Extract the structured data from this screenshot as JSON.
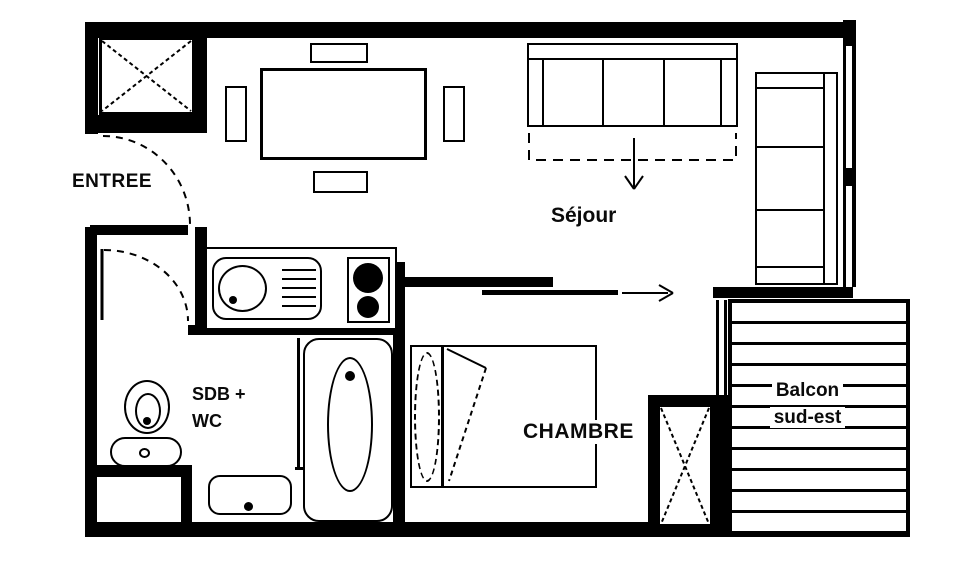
{
  "plan": {
    "kind": "apartment-floor-plan",
    "colors": {
      "wall": "#000000",
      "background": "#ffffff",
      "line": "#000000"
    },
    "labels": {
      "entree": "ENTREE",
      "sejour": "Séjour",
      "sdb_line1": "SDB +",
      "sdb_line2": "WC",
      "chambre": "CHAMBRE",
      "balcon_line1": "Balcon",
      "balcon_line2": "sud-est"
    },
    "symbols": [
      "crossed-closet-icon",
      "dining-table-icon",
      "chair-icon",
      "sofa-three-seat-icon",
      "convertible-sofa-arrow-icon",
      "chaise-sofa-icon",
      "kitchen-sink-icon",
      "stove-burners-icon",
      "sliding-door-arrow-icon",
      "bed-icon",
      "pillow-icon",
      "duvet-icon",
      "bathtub-icon",
      "toilet-icon",
      "washbasin-icon",
      "window-icon",
      "door-swing-arc-icon",
      "balcony-decking-icon"
    ]
  }
}
